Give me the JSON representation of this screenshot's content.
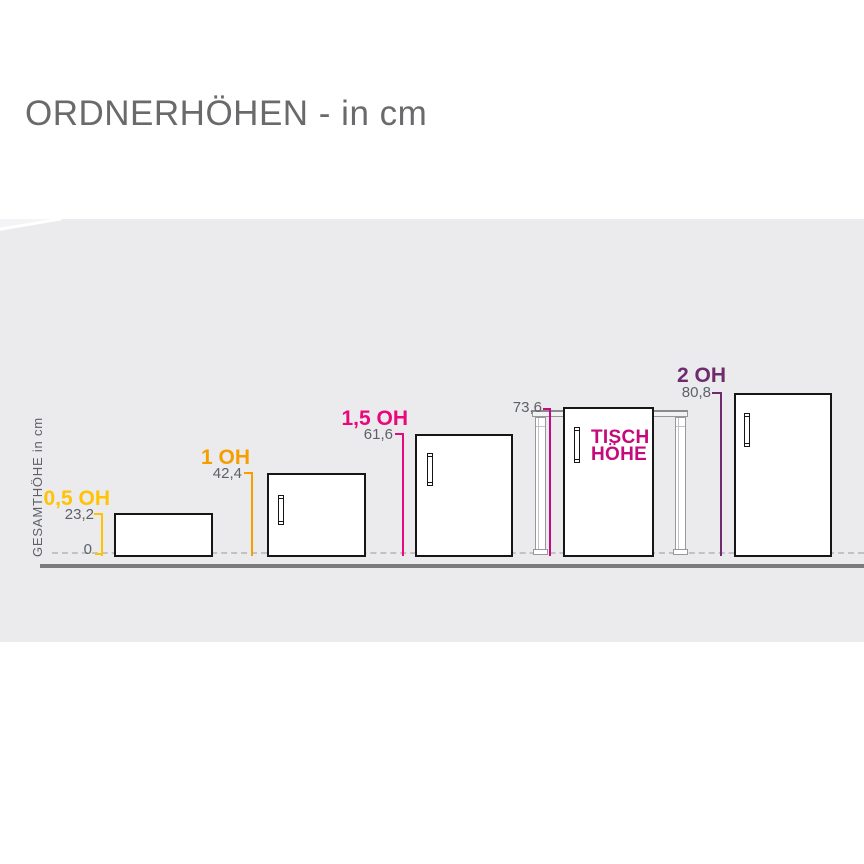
{
  "title": "ORDNERHÖHEN - in cm",
  "axis": {
    "label": "GESAMTHÖHE in cm",
    "zero": "0"
  },
  "measurements": {
    "oh05": {
      "label": "0,5 OH",
      "value": "23,2"
    },
    "oh1": {
      "label": "1 OH",
      "value": "42,4"
    },
    "oh15": {
      "label": "1,5 OH",
      "value": "61,6"
    },
    "tisch": {
      "value": "73,6",
      "label_line1": "TISCH",
      "label_line2": "HÖHE"
    },
    "oh2": {
      "label": "2 OH",
      "value": "80,8"
    }
  },
  "colors": {
    "oh05": "#FFC303",
    "oh1": "#F59E00",
    "oh15": "#EA077C",
    "tisch": "#C40A7C",
    "oh2": "#6F2B6D",
    "value-text": "#5D6167",
    "title-text": "#6A6A6D",
    "panel": "#EBEBED",
    "floor": "#7B7B7D",
    "dash": "#C2C2C4",
    "cabinet-border": "#161616"
  },
  "chart_data": {
    "type": "bar",
    "title": "ORDNERHÖHEN - in cm",
    "ylabel": "GESAMTHÖHE in cm",
    "categories": [
      "0,5 OH",
      "1 OH",
      "1,5 OH",
      "TISCH HÖHE",
      "2 OH"
    ],
    "values": [
      23.2,
      42.4,
      61.6,
      73.6,
      80.8
    ],
    "unit": "cm",
    "ylim": [
      0,
      80.8
    ],
    "grid": false,
    "legend": false
  }
}
